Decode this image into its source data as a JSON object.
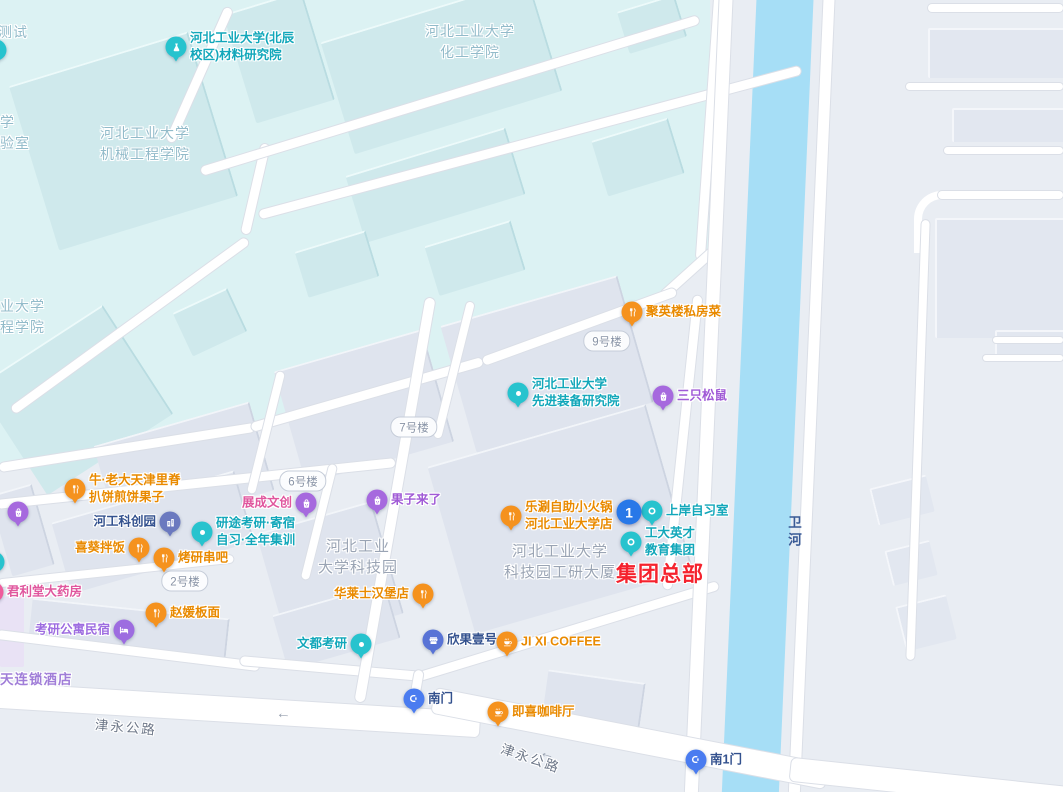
{
  "palette": {
    "food_pin": "#f5921e",
    "food_text": "#e98a00",
    "shop_pin": "#a669de",
    "shop_text": "#a05ad6",
    "edu_pin": "#27c3ce",
    "edu_text": "#12a7ba",
    "place_pin": "#6b79bf",
    "place_text": "#33518e",
    "place2_pin": "#5873d6",
    "place2_text": "#33518e",
    "gate_pin": "#4a7cf0",
    "gate_text": "#33518e",
    "hotel_pin": "#9d6ce0",
    "hotel_text": "#9d6ce0",
    "pharm_pin": "#ef5b9c",
    "pharm_text": "#e0579e",
    "navy": "#33518e",
    "pink": "#e0579e",
    "purple": "#9d6ce0",
    "highlight_red": "#f5222d",
    "marker_blue": "#2878e8",
    "campus_label": "#92bbca",
    "district_label": "#9aa4b4",
    "road_label": "#6e7889",
    "river_label": "#3a5a96",
    "river_fill": "#a6def6"
  },
  "selected_marker": {
    "number": "1",
    "x": 629,
    "y": 512
  },
  "highlight": {
    "text": "集团总部",
    "x": 616,
    "y": 573
  },
  "river_label": {
    "text": "卫河",
    "x": 783,
    "y": 515
  },
  "arrow_char": "←",
  "road_arrows": [
    {
      "x": 276,
      "y": 706,
      "rotate": 4
    },
    {
      "x": 540,
      "y": 746,
      "rotate": 17
    }
  ],
  "road_labels": [
    {
      "text": "津永公路",
      "x": 95,
      "y": 716,
      "rotate": 5
    },
    {
      "text": "津永公路",
      "x": 500,
      "y": 747,
      "rotate": 19
    }
  ],
  "building_pills": [
    {
      "text": "9号楼",
      "x": 607,
      "y": 341
    },
    {
      "text": "7号楼",
      "x": 414,
      "y": 427
    },
    {
      "text": "6号楼",
      "x": 303,
      "y": 481
    },
    {
      "text": "2号楼",
      "x": 185,
      "y": 581
    }
  ],
  "area_labels": [
    {
      "text": "河北工业大学\n机械工程学院",
      "x": 145,
      "y": 144,
      "zone": "campus"
    },
    {
      "text": "河北工业大学\n化工学院",
      "x": 470,
      "y": 42,
      "zone": "campus"
    },
    {
      "text": "河北工业\n大学科技园",
      "x": 358,
      "y": 557,
      "zone": "district"
    },
    {
      "text": "河北工业大学\n科技园工研大厦",
      "x": 560,
      "y": 562,
      "zone": "district"
    },
    {
      "text": "测试",
      "x": -2,
      "y": 22,
      "zone": "campus",
      "edge": true
    },
    {
      "text": "学\n验室",
      "x": 0,
      "y": 112,
      "zone": "campus",
      "edge": true
    },
    {
      "text": "业大学\n程学院",
      "x": 0,
      "y": 296,
      "zone": "campus",
      "edge": true
    },
    {
      "text": "天连锁酒店",
      "x": 0,
      "y": 669,
      "zone": "hotel",
      "edge": true
    }
  ],
  "pois": [
    {
      "id": "cailiao-yanjiuyuan",
      "label": "河北工业大学(北辰\n校区)材料研究院",
      "x": 176,
      "y": 47,
      "type": "edu",
      "glyph": "flask",
      "side": "right"
    },
    {
      "id": "juyinglou-sifangcai",
      "label": "聚英楼私房菜",
      "x": 632,
      "y": 312,
      "type": "food",
      "glyph": "fork",
      "side": "right"
    },
    {
      "id": "xianjin-zhuangbei-yanjiuyuan",
      "label": "河北工业大学\n先进装备研究院",
      "x": 518,
      "y": 393,
      "type": "edu",
      "glyph": "dot",
      "side": "right"
    },
    {
      "id": "sanzhisongshu",
      "label": "三只松鼠",
      "x": 663,
      "y": 396,
      "type": "shop",
      "glyph": "bag",
      "side": "right"
    },
    {
      "id": "niulaoda-jianbing",
      "label": "牛·老大天津里脊\n扒饼煎饼果子",
      "x": 75,
      "y": 489,
      "type": "food",
      "glyph": "fork",
      "side": "right"
    },
    {
      "id": "edge-shop-pin",
      "label": "",
      "x": 18,
      "y": 512,
      "type": "shop",
      "glyph": "bag",
      "side": "right"
    },
    {
      "id": "zhancheng-wenchuang",
      "label": "展成文创",
      "x": 306,
      "y": 503,
      "type": "shop",
      "glyph": "bag",
      "side": "left",
      "text_color": "pink"
    },
    {
      "id": "guozilaile",
      "label": "果子来了",
      "x": 377,
      "y": 500,
      "type": "shop",
      "glyph": "bag",
      "side": "right"
    },
    {
      "id": "hegong-kechuangyuan",
      "label": "河工科创园",
      "x": 170,
      "y": 522,
      "type": "place",
      "glyph": "building",
      "side": "left"
    },
    {
      "id": "yantu-kaoyan",
      "label": "研途考研·寄宿\n自习·全年集训",
      "x": 202,
      "y": 532,
      "type": "edu",
      "glyph": "dot",
      "side": "right"
    },
    {
      "id": "xikui-banfan",
      "label": "喜葵拌饭",
      "x": 139,
      "y": 548,
      "type": "food",
      "glyph": "fork",
      "side": "left"
    },
    {
      "id": "kaoyan-chuanba",
      "label": "烤研串吧",
      "x": 164,
      "y": 558,
      "type": "food",
      "glyph": "fork",
      "side": "right"
    },
    {
      "id": "leshuan-zizhu-xiaohuoguo",
      "label": "乐涮自助小火锅\n河北工业大学店",
      "x": 511,
      "y": 516,
      "type": "food",
      "glyph": "fork",
      "side": "right"
    },
    {
      "id": "shangan-zixishi",
      "label": "上岸自习室",
      "x": 652,
      "y": 511,
      "type": "edu",
      "glyph": "ring",
      "side": "right"
    },
    {
      "id": "gongda-yingcai-jiaoyu",
      "label": "工大英才\n教育集团",
      "x": 631,
      "y": 542,
      "type": "edu",
      "glyph": "ring",
      "side": "right"
    },
    {
      "id": "junlitang-dayaofang",
      "label": "君利堂大药房",
      "x": -7,
      "y": 592,
      "type": "pharm",
      "glyph": "cross",
      "side": "right"
    },
    {
      "id": "zhaoyuan-banmian",
      "label": "赵媛板面",
      "x": 156,
      "y": 613,
      "type": "food",
      "glyph": "fork",
      "side": "right"
    },
    {
      "id": "kaoyan-gongyu-minsu",
      "label": "考研公寓民宿",
      "x": 124,
      "y": 630,
      "type": "hotel",
      "glyph": "bed",
      "side": "left"
    },
    {
      "id": "hualaishi-hanbaodian",
      "label": "华莱士汉堡店",
      "x": 423,
      "y": 594,
      "type": "food",
      "glyph": "fork",
      "side": "left"
    },
    {
      "id": "wendu-kaoyan",
      "label": "文都考研",
      "x": 361,
      "y": 644,
      "type": "edu",
      "glyph": "dot",
      "side": "left"
    },
    {
      "id": "xinguo-yihao",
      "label": "欣果壹号",
      "x": 433,
      "y": 640,
      "type": "place2",
      "glyph": "shopfront",
      "side": "right"
    },
    {
      "id": "jixi-coffee",
      "label": "JI XI COFFEE",
      "x": 507,
      "y": 642,
      "type": "food",
      "glyph": "coffee",
      "side": "right"
    },
    {
      "id": "nanmen",
      "label": "南门",
      "x": 414,
      "y": 699,
      "type": "gate",
      "glyph": "gate",
      "side": "right"
    },
    {
      "id": "jixi-kafeiting",
      "label": "即喜咖啡厅",
      "x": 498,
      "y": 712,
      "type": "food",
      "glyph": "coffee",
      "side": "right"
    },
    {
      "id": "nan1men",
      "label": "南1门",
      "x": 696,
      "y": 760,
      "type": "gate",
      "glyph": "gate",
      "side": "right"
    },
    {
      "id": "edge-edu-pin-mid",
      "label": "",
      "x": -6,
      "y": 562,
      "type": "edu",
      "glyph": "dot",
      "side": "right"
    },
    {
      "id": "edge-edu-pin-top",
      "label": "",
      "x": -4,
      "y": 50,
      "type": "edu",
      "glyph": "dot",
      "side": "right"
    }
  ]
}
